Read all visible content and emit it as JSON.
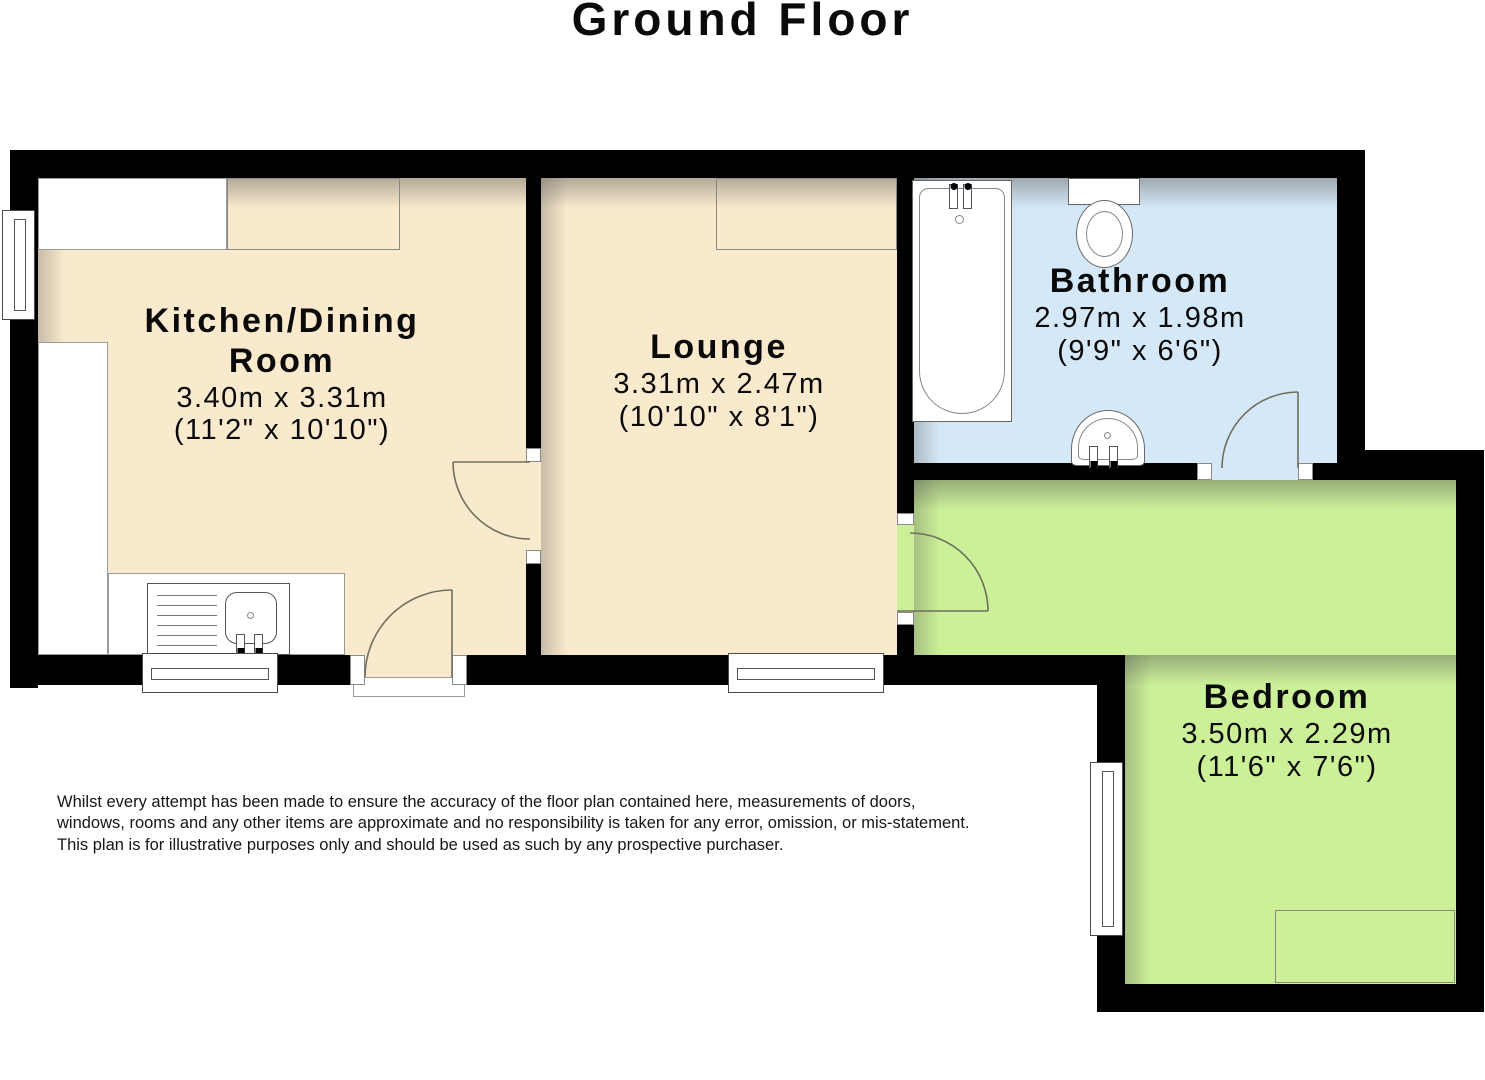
{
  "title": "Ground Floor",
  "rooms": {
    "kitchen": {
      "name": "Kitchen/Dining Room",
      "metric": "3.40m x 3.31m",
      "imperial": "(11'2\" x 10'10\")"
    },
    "lounge": {
      "name": "Lounge",
      "metric": "3.31m x 2.47m",
      "imperial": "(10'10\" x 8'1\")"
    },
    "bathroom": {
      "name": "Bathroom",
      "metric": "2.97m x 1.98m",
      "imperial": "(9'9\" x 6'6\")"
    },
    "bedroom": {
      "name": "Bedroom",
      "metric": "3.50m x 2.29m",
      "imperial": "(11'6\" x 7'6\")"
    }
  },
  "disclaimer": {
    "lines": [
      "Whilst every attempt has been made to ensure the accuracy of the floor plan contained here, measurements of doors,",
      "windows, rooms and any other items are approximate and no responsibility is taken for any error, omission, or mis-statement.",
      "This plan is for illustrative purposes only and should be used as such by any prospective purchaser."
    ]
  },
  "fixtures": [
    "bathtub",
    "toilet",
    "basin",
    "kitchen-sink"
  ],
  "colors": {
    "wall": "#000000",
    "floor_main": "#FAEACD",
    "floor_bathroom": "#D5E8F7",
    "floor_bedroom": "#CBF098",
    "outline": "#666666"
  }
}
